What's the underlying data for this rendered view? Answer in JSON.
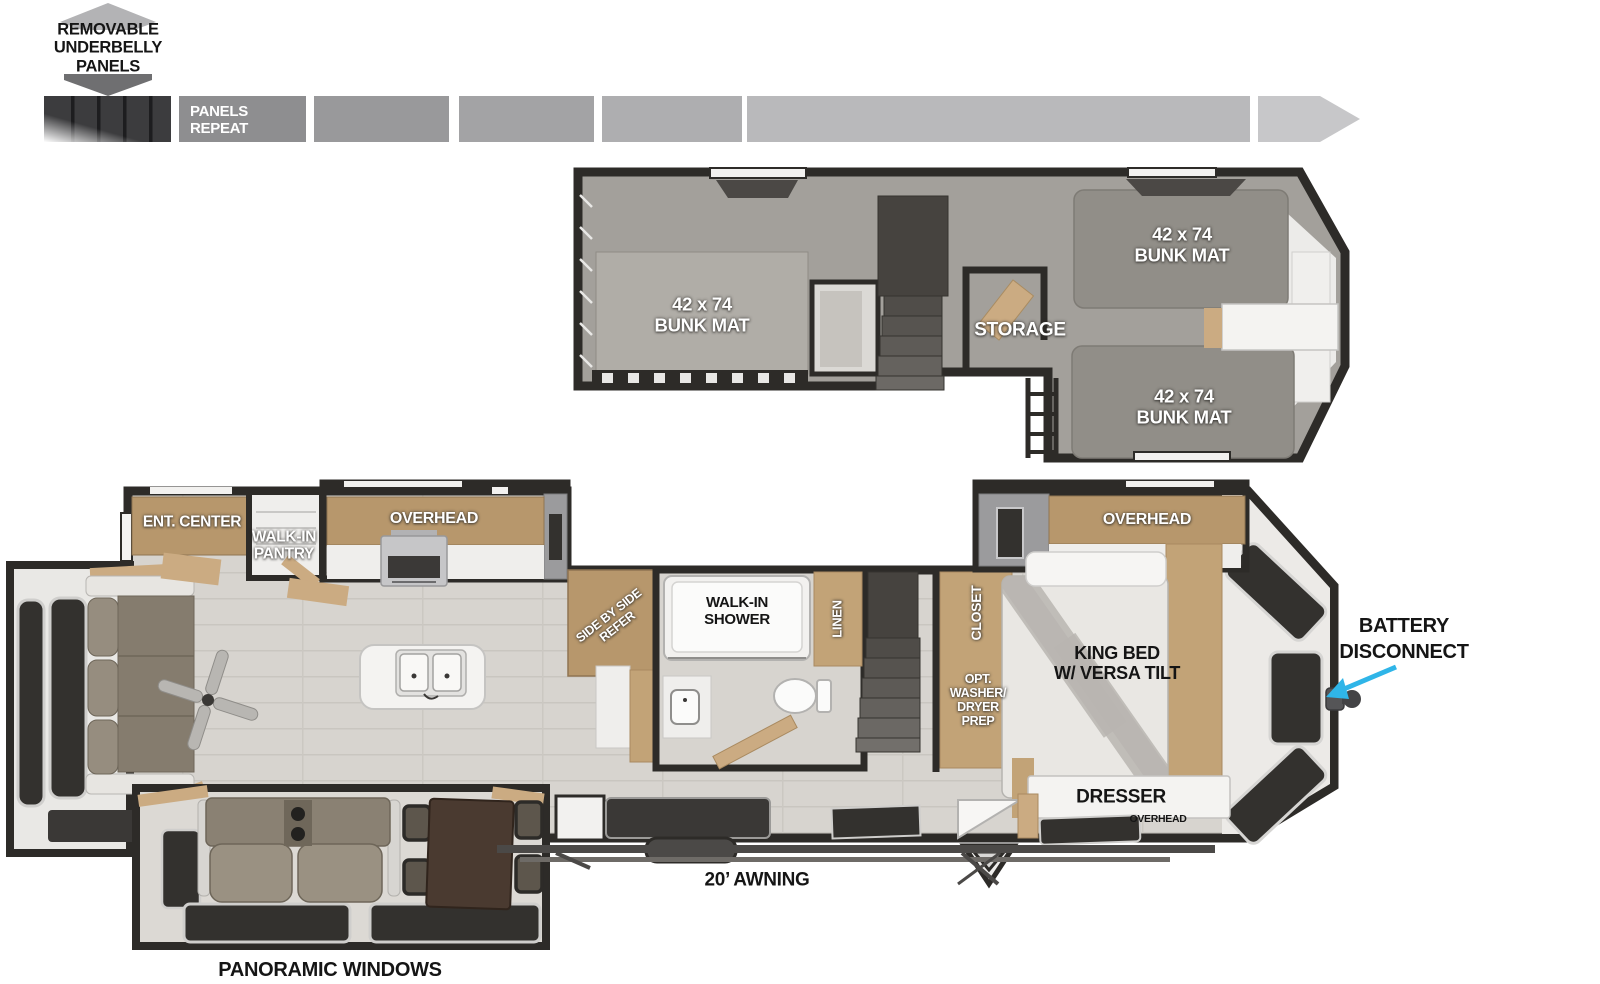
{
  "underbelly": {
    "note": "REMOVABLE\nUNDERBELLY\nPANELS",
    "panels_repeat": "PANELS\nREPEAT"
  },
  "loft": {
    "bunk_left": "42 x 74\nBUNK MAT",
    "bunk_top": "42 x 74\nBUNK MAT",
    "bunk_bottom": "42 x 74\nBUNK MAT",
    "storage": "STORAGE"
  },
  "main": {
    "ent_center": "ENT. CENTER",
    "walk_in_pantry": "WALK-IN\nPANTRY",
    "overhead_kitchen": "OVERHEAD",
    "refer": "SIDE BY SIDE\nREFER",
    "walk_in_shower": "WALK-IN\nSHOWER",
    "linen": "LINEN",
    "closet": "CLOSET",
    "washer_prep": "OPT.\nWASHER/\nDRYER\nPREP",
    "king_bed": "KING BED\nW/ VERSA TILT",
    "overhead_bedroom": "OVERHEAD",
    "dresser": "DRESSER",
    "overhead_dresser": "OVERHEAD",
    "battery_disconnect": "BATTERY\nDISCONNECT",
    "awning": "20’ AWNING",
    "panoramic_windows": "PANORAMIC WINDOWS"
  },
  "colors": {
    "wall": "#2d2b28",
    "loft_floor": "#a3a09b",
    "bunk": "#918e88",
    "wood": "#c2a377",
    "wood_dark": "#b7976c",
    "floor": "#d7d4cf",
    "window": "#33312e",
    "slide_gray": "#9b9b9d",
    "accent_arrow": "#2fb5e8"
  }
}
